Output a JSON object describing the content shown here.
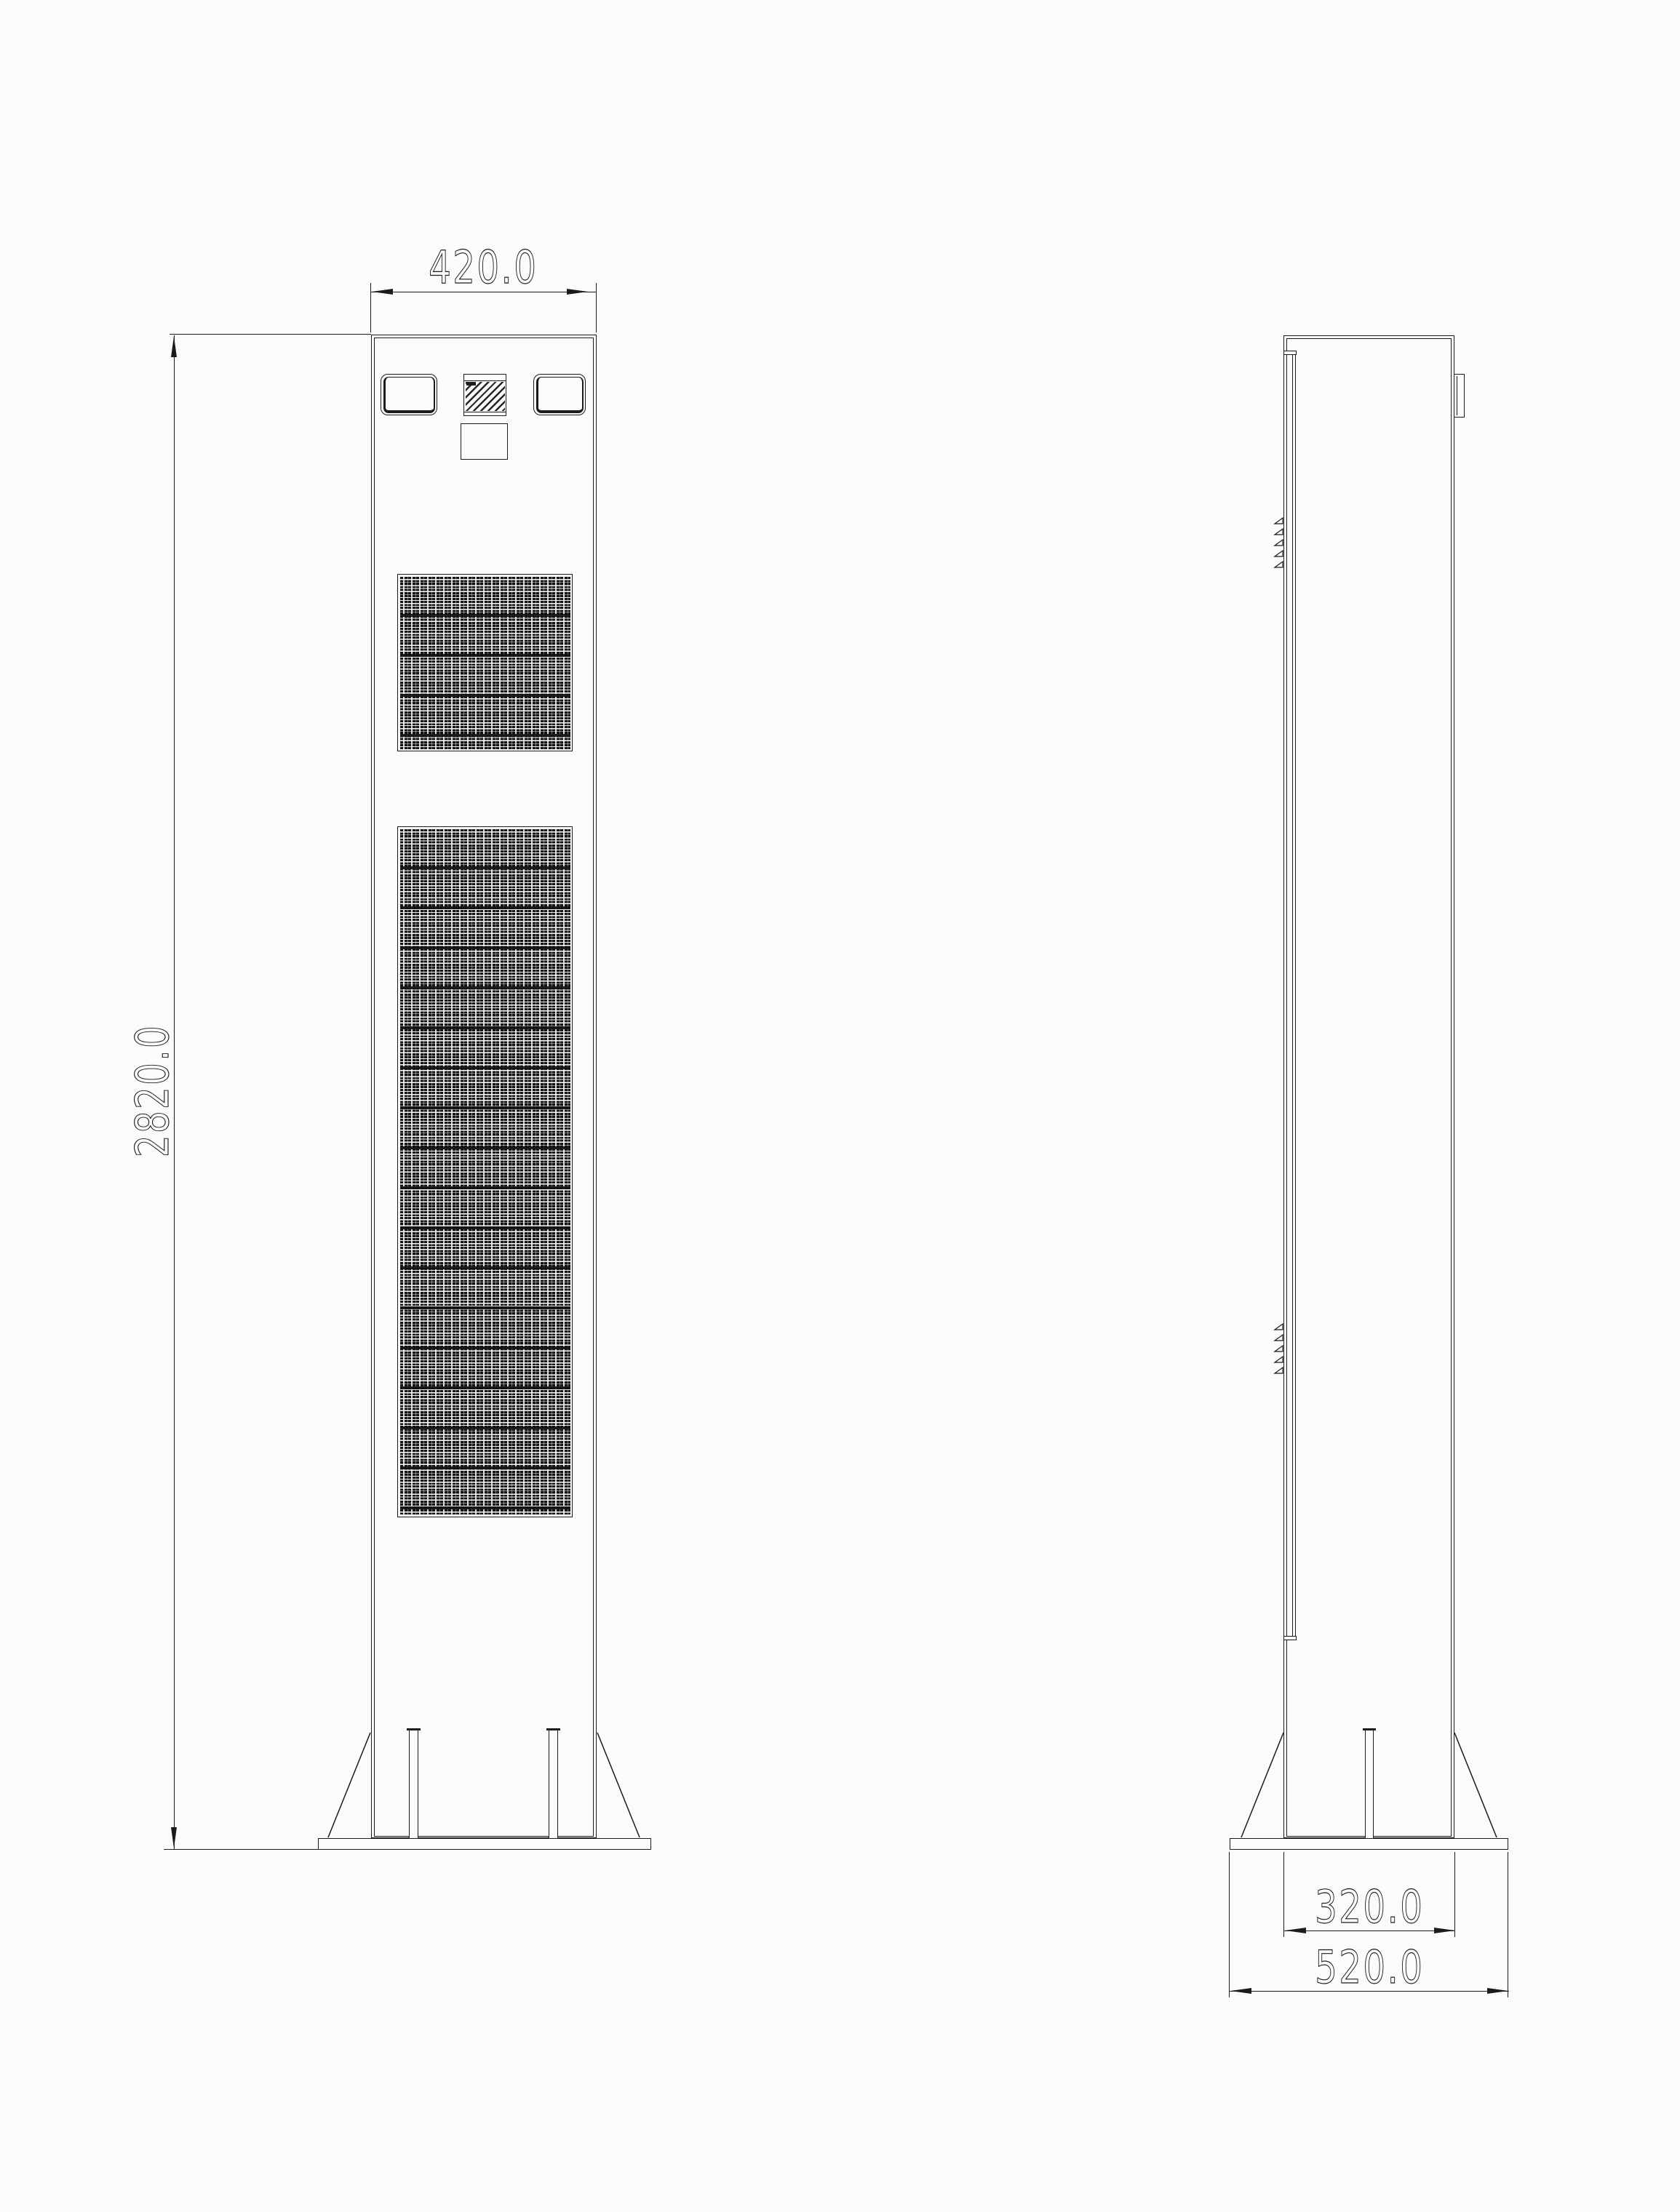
{
  "meta": {
    "background_color": "#fbfbfb",
    "line_color": "#1b1b1b",
    "drawing_style": "CAD outline technical drawing, two orthographic views of a tower cabinet"
  },
  "front_view": {
    "name": "front elevation",
    "width_dim": "420.0",
    "height_dim": "2820.0",
    "features": {
      "speaker_left": "rounded-rectangle window",
      "camera_window": "hatched square window with indicator chip",
      "speaker_right": "rounded-rectangle window",
      "display_window": "small plain rectangle",
      "grille_upper": "square ventilation mesh",
      "grille_lower": "tall ventilation mesh",
      "base": "base plate with two anchor bolts and two gussets"
    }
  },
  "side_view": {
    "name": "side elevation",
    "body_depth_dim": "320.0",
    "base_depth_dim": "520.0",
    "features": {
      "door_panel": "thin front door panel seen edge-on",
      "hinge_bracket": "small bracket on rear edge",
      "louver_marks_upper": "5 tick marks",
      "louver_marks_lower": "5 tick marks",
      "base": "base plate with center anchor bolt and two gussets"
    }
  }
}
